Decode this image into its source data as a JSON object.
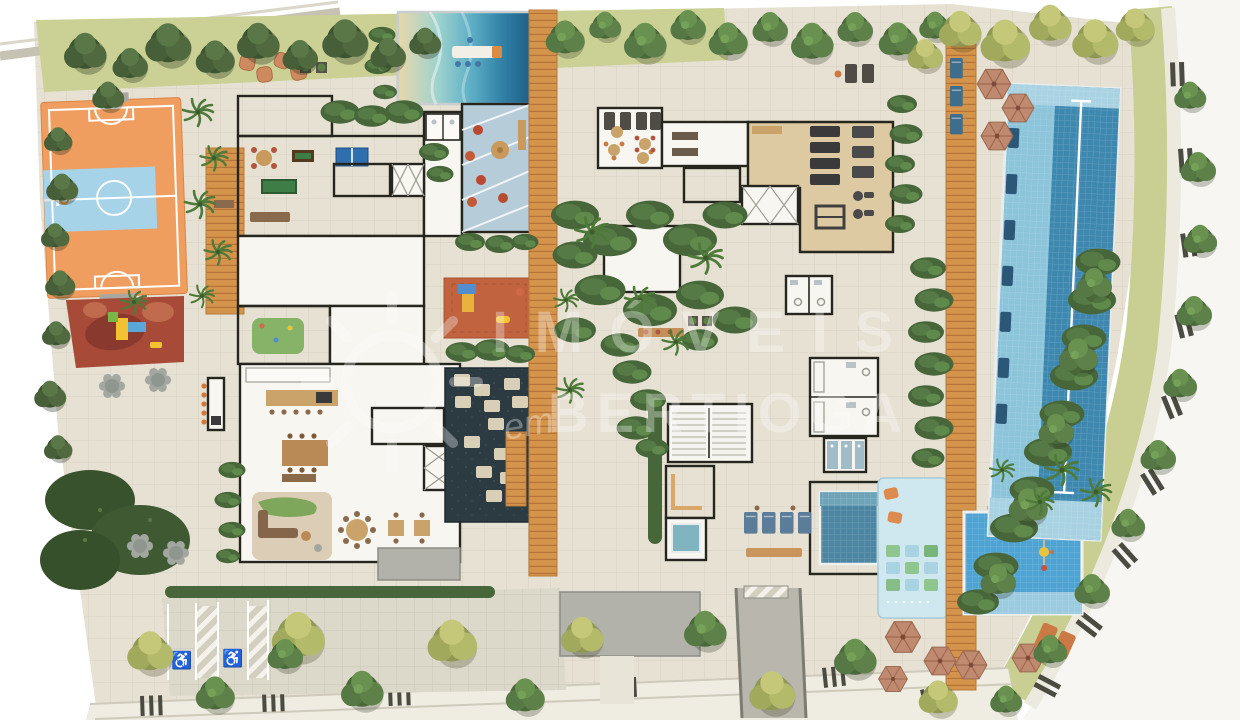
{
  "image_type": "architectural site plan rendering (top-down) of a residential condominium leisure / ground floor",
  "watermark": {
    "logo": "sun-logo",
    "line1": "IMÓVEIS",
    "line2_prefix": "em",
    "line2": "BERTIOGA",
    "color": "#ffffff",
    "opacity": 0.32
  },
  "parking": {
    "accessible_spaces": 2,
    "accessible_icon": "♿"
  },
  "areas": [
    "sports-court",
    "small-playground",
    "central-playground",
    "beach-entry-pool",
    "kids-glass-playroom",
    "game-room",
    "toy-room",
    "reflecting-pond",
    "stepping-stones",
    "main-boardwalk",
    "central-garden",
    "gym",
    "relaxation-room",
    "sauna",
    "cold-plunge",
    "changing-rooms",
    "showers",
    "spa-pool",
    "lap-pool",
    "kids-pool",
    "splash-pad",
    "sun-deck-umbrellas",
    "gourmet-lounge",
    "dining-area",
    "bbq-counter",
    "accessible-parking",
    "street-trees",
    "perimeter-road"
  ],
  "palette": {
    "paving": "#e6e1d3",
    "grass": "#cbd095",
    "road-white": "#f7f6f2",
    "sidewalk": "#efece1",
    "stripe": "#4b4b42",
    "wall": "#26261f",
    "room": "#f7f6f1",
    "wood-floor": "#d6a96f",
    "wood-deck": "#d5944c",
    "court-orange": "#f09e60",
    "court-blue": "#a6d3e8",
    "playground-red": "#a74b38",
    "terracotta": "#c2633f",
    "pond": "#2c3a41",
    "sand": "#e9d8ab",
    "pool-deep": "#205f86",
    "lap-light": "#8cc4da",
    "lap-deep": "#3e88b0",
    "kids-pool": "#4ea3d2",
    "splash": "#cfe7ef",
    "spa": "#4d86a2",
    "glass": "#b7ccd9",
    "gym": "#decaa2",
    "tree-dark": "#3c5530",
    "tree-green": "#4a683a",
    "tree-yellow": "#a1a95c",
    "hedge": "#47673a",
    "umbrella": "#c08a70",
    "lounger-navy": "#2c5878",
    "lounger-orange": "#cc7a45",
    "canopy": "#b2b2aa",
    "driveway": "#b8b6ad",
    "watermark": "#ffffff"
  }
}
